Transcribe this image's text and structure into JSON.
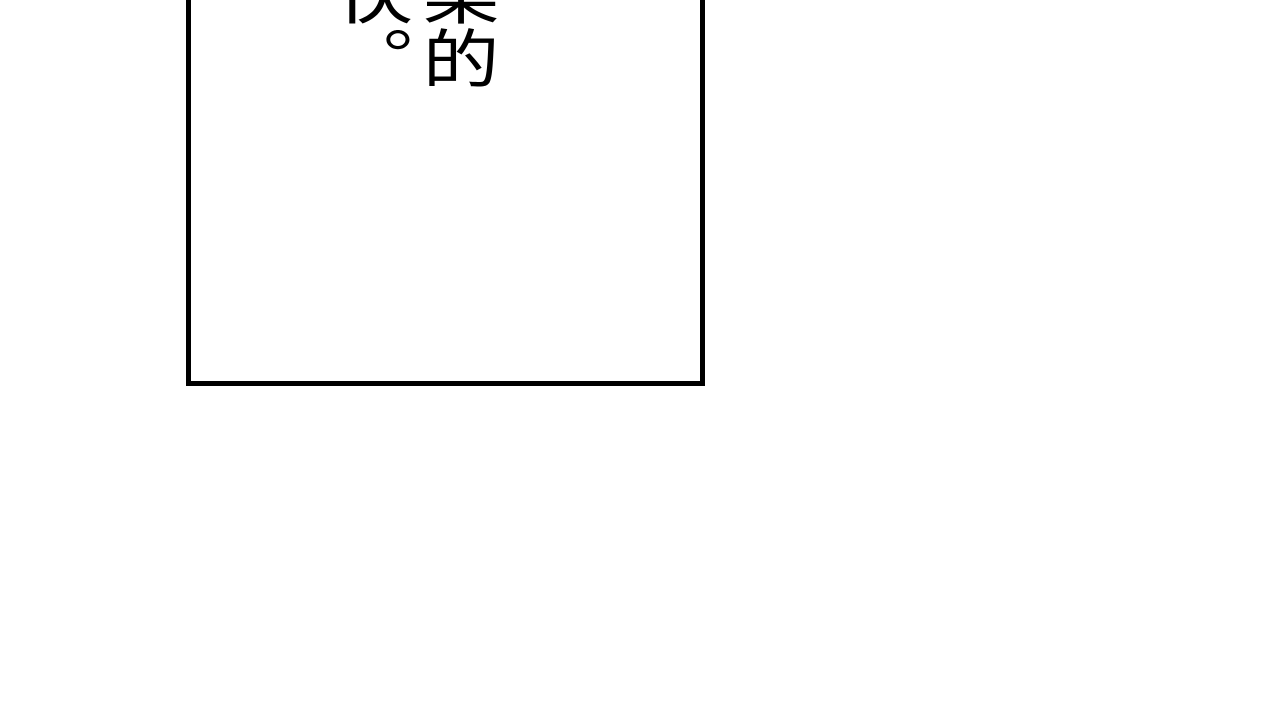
{
  "page": {
    "background_color": "#ffffff"
  },
  "panel": {
    "border_color": "#000000",
    "fill_color": "#ffffff"
  },
  "speech_text": {
    "vertical_text": "柔的\n伙。",
    "visible_characters": [
      "柔",
      "的",
      "伙",
      "。"
    ],
    "color": "#000000",
    "writing_direction": "vertical-rl"
  }
}
